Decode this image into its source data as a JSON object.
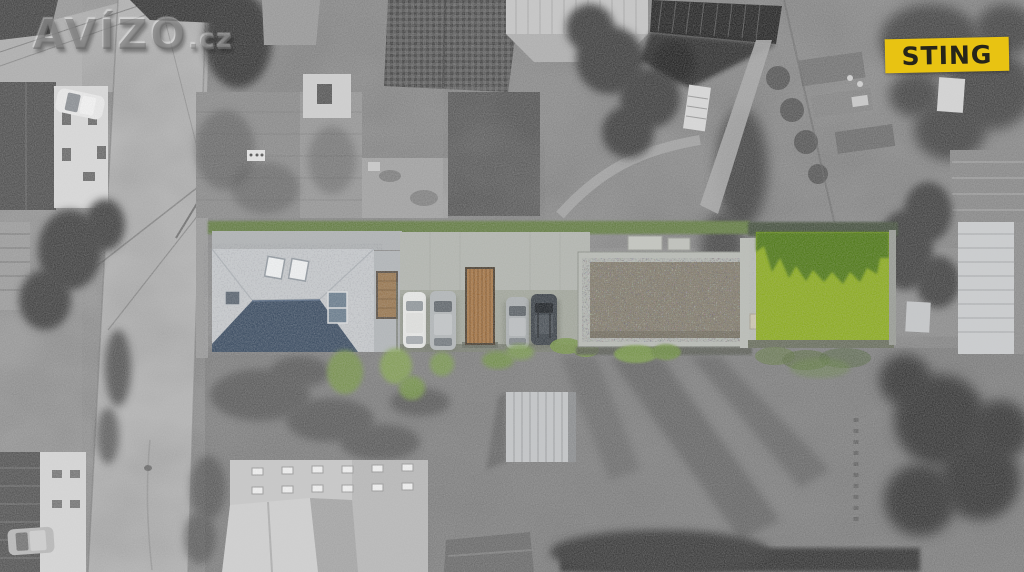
{
  "watermark": {
    "brand": "AVÍZO",
    "suffix": ".cz"
  },
  "badge": {
    "label": "STING"
  },
  "colors": {
    "badge_bg": "#e8c312",
    "badge_text": "#26251a",
    "lawn": "#8fae25",
    "lawn_shadow": "#527c1c",
    "hedge": "#68804a",
    "hedge_dark": "#4c5645",
    "roof_light": "#c7cacd",
    "roof_shadow": "#3d4e63",
    "roof_window": "#6e8090",
    "gate_wood": "#a87a4b",
    "gravel": "#87806f",
    "pavement": "#a4a89e",
    "wall": "#b3b6b0",
    "car_white": "#e7e8e6",
    "car_silver": "#b3b7b9",
    "car_silver2": "#aeb2b4",
    "car_dark": "#42484e",
    "bush": "#7c9850"
  }
}
